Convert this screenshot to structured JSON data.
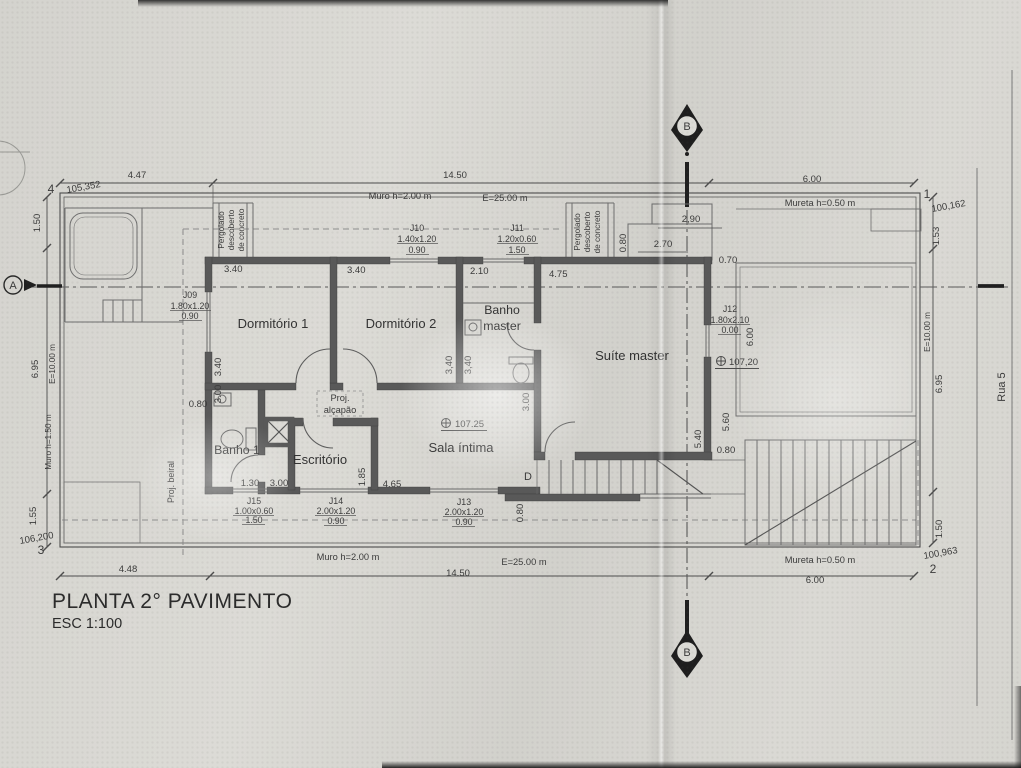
{
  "title": {
    "name": "PLANTA 2° PAVIMENTO",
    "scale": "ESC 1:100"
  },
  "rooms": {
    "dorm1": "Dormitório 1",
    "dorm2": "Dormitório 2",
    "banho_master_l1": "Banho",
    "banho_master_l2": "master",
    "suite": "Suíte master",
    "sala": "Sala íntima",
    "escritorio": "Escritório",
    "banho1": "Banho 1",
    "alcapao_l1": "Proj.",
    "alcapao_l2": "alçapão",
    "beiral": "Proj. beiral",
    "door_d": "D"
  },
  "windows": {
    "j09": {
      "id": "J09",
      "size": "1.80x1.20",
      "sill": "0.90"
    },
    "j10": {
      "id": "J10",
      "size": "1.40x1.20",
      "sill": "0.90"
    },
    "j11": {
      "id": "J11",
      "size": "1.20x0.60",
      "sill": "1.50"
    },
    "j12": {
      "id": "J12",
      "size": "1.80x2.10",
      "sill": "0.00"
    },
    "j13": {
      "id": "J13",
      "size": "2.00x1.20",
      "sill": "0.90"
    },
    "j14": {
      "id": "J14",
      "size": "2.00x1.20",
      "sill": "0.90"
    },
    "j15": {
      "id": "J15",
      "size": "1.00x0.60",
      "sill": "1.50"
    }
  },
  "levels": {
    "sala": "107.25",
    "terrace": "107,20"
  },
  "dims": {
    "top": [
      "4.47",
      "14.50",
      "6.00"
    ],
    "bottom": [
      "4.48",
      "14.50",
      "6.00"
    ],
    "left": [
      "1.50",
      "6.95",
      "1.55"
    ],
    "right": [
      "1.53",
      "6.95",
      "1.50"
    ]
  },
  "room_dims": {
    "dorm1_w": "3.40",
    "dorm2_w": "3.40",
    "banho_w": "2.10",
    "suite_w": "4.75",
    "dorm1_d": "3.40",
    "dorm1_d2": "3.00",
    "banho_d1": "3,40",
    "banho_d2": "3,40",
    "sala_d": "3.00",
    "stair_w": "0.80",
    "esc_off": "1.30",
    "esc_w": "3.00",
    "esc_d": "1.85",
    "sala_w": "4.65",
    "suite_e1": "5.60",
    "suite_e2": "5.40",
    "suite_e3": "0.80",
    "terr_d": "6.00",
    "balc1": "2,90",
    "balc2": "2.70",
    "balc3": "0.80",
    "balc4": "0.70",
    "beiral_off": "0.80"
  },
  "site": {
    "muro_top": "Muro h=2.00 m",
    "wall_len_top": "E=25.00 m",
    "mureta_top": "Mureta h=0.50 m",
    "muro_bottom": "Muro h=2.00 m",
    "wall_len_bottom": "E=25.00 m",
    "mureta_bottom": "Mureta h=0.50 m",
    "muro_left": "Muro h=1.50 m",
    "side_len_left": "E=10.00 m",
    "side_len_right": "E=10.00 m",
    "street": "Rua 5",
    "pergolado_l1": "Pergolado",
    "pergolado_l2": "descoberto",
    "pergolado_l3": "de concreto"
  },
  "corners": {
    "c1": {
      "n": "1",
      "elev": "100,162"
    },
    "c2": {
      "n": "2",
      "elev": "100,963"
    },
    "c3": {
      "n": "3",
      "elev": "106,200"
    },
    "c4": {
      "n": "4",
      "elev": "105,352"
    }
  },
  "sections": {
    "a": "A",
    "b": "B"
  }
}
